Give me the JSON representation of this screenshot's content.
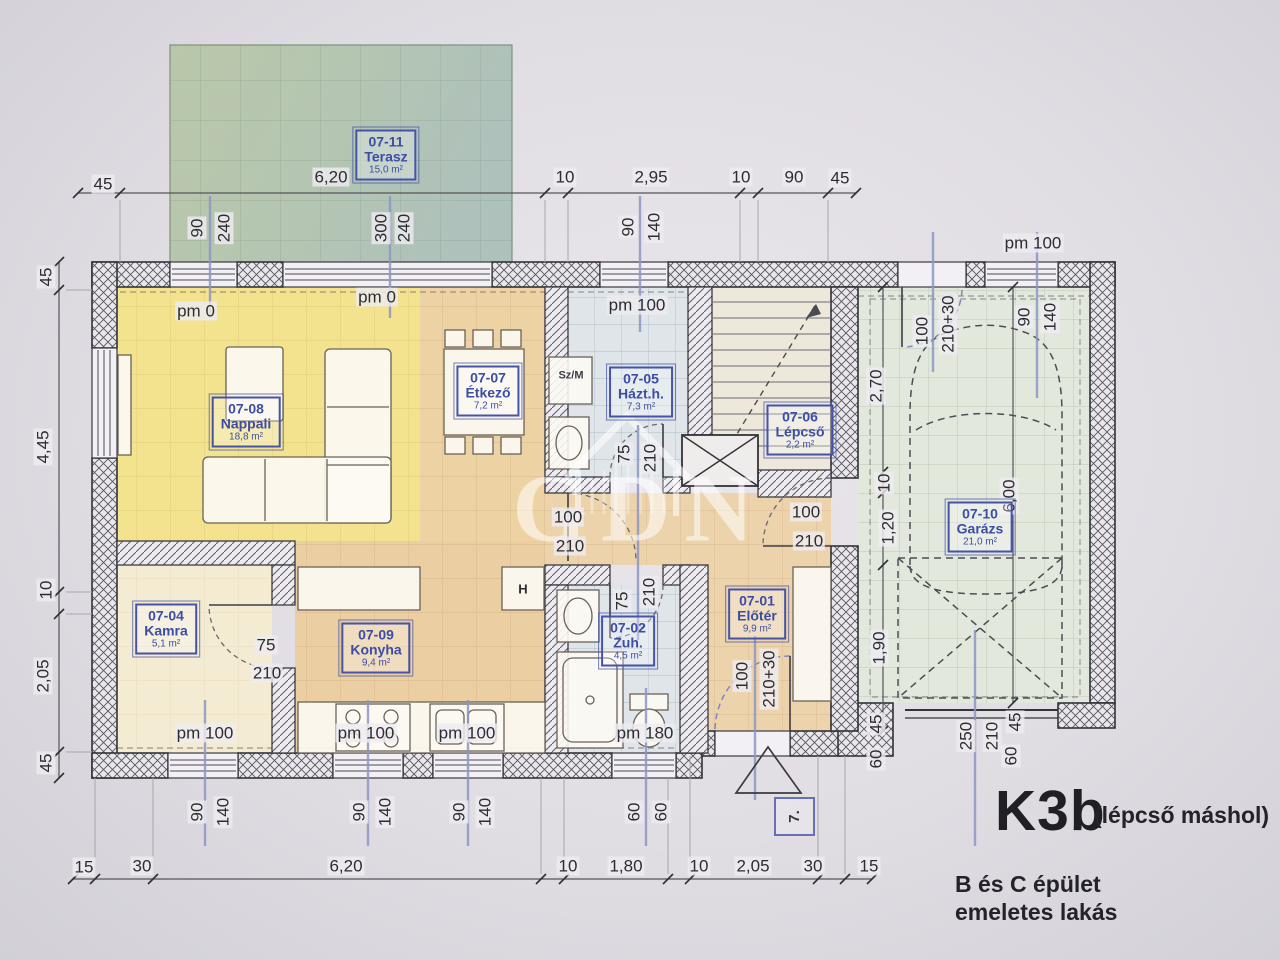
{
  "title": {
    "code": "K3b",
    "note": "(lépcső máshol)",
    "building_line1": "B és C épület",
    "building_line2": "emeletes lakás",
    "stamp": "7."
  },
  "watermark": {
    "text": "GDN"
  },
  "rooms": [
    {
      "code": "07-11",
      "name": "Terasz",
      "area": "15,0 m²",
      "x": 386,
      "y": 155
    },
    {
      "code": "07-08",
      "name": "Nappali",
      "area": "18,8 m²",
      "x": 246,
      "y": 422
    },
    {
      "code": "07-07",
      "name": "Étkező",
      "area": "7,2 m²",
      "x": 488,
      "y": 391
    },
    {
      "code": "07-05",
      "name": "Házt.h.",
      "area": "7,3 m²",
      "x": 641,
      "y": 392
    },
    {
      "code": "07-06",
      "name": "Lépcső",
      "area": "2,2 m²",
      "x": 800,
      "y": 430
    },
    {
      "code": "07-10",
      "name": "Garázs",
      "area": "21,0 m²",
      "x": 980,
      "y": 527
    },
    {
      "code": "07-04",
      "name": "Kamra",
      "area": "5,1 m²",
      "x": 166,
      "y": 629
    },
    {
      "code": "07-09",
      "name": "Konyha",
      "area": "9,4 m²",
      "x": 376,
      "y": 648
    },
    {
      "code": "07-02",
      "name": "Zuh.",
      "area": "4,5 m²",
      "x": 628,
      "y": 641
    },
    {
      "code": "07-01",
      "name": "Előtér",
      "area": "9,9 m²",
      "x": 757,
      "y": 614
    }
  ],
  "dims": [
    {
      "t": "45",
      "x": 103,
      "y": 184
    },
    {
      "t": "6,20",
      "x": 331,
      "y": 177
    },
    {
      "t": "10",
      "x": 565,
      "y": 177
    },
    {
      "t": "2,95",
      "x": 651,
      "y": 177
    },
    {
      "t": "10",
      "x": 741,
      "y": 177
    },
    {
      "t": "90",
      "x": 794,
      "y": 177
    },
    {
      "t": "45",
      "x": 840,
      "y": 178
    },
    {
      "t": "pm 100",
      "x": 1033,
      "y": 243
    },
    {
      "t": "pm 0",
      "x": 196,
      "y": 311
    },
    {
      "t": "pm 0",
      "x": 377,
      "y": 297
    },
    {
      "t": "pm 100",
      "x": 637,
      "y": 305
    },
    {
      "t": "15",
      "x": 84,
      "y": 867
    },
    {
      "t": "30",
      "x": 142,
      "y": 866
    },
    {
      "t": "6,20",
      "x": 346,
      "y": 866
    },
    {
      "t": "10",
      "x": 568,
      "y": 866
    },
    {
      "t": "1,80",
      "x": 626,
      "y": 866
    },
    {
      "t": "10",
      "x": 699,
      "y": 866
    },
    {
      "t": "2,05",
      "x": 753,
      "y": 866
    },
    {
      "t": "30",
      "x": 813,
      "y": 866
    },
    {
      "t": "15",
      "x": 869,
      "y": 866
    },
    {
      "t": "pm 100",
      "x": 205,
      "y": 733
    },
    {
      "t": "pm 100",
      "x": 366,
      "y": 733
    },
    {
      "t": "pm 100",
      "x": 467,
      "y": 733
    },
    {
      "t": "pm 180",
      "x": 645,
      "y": 733
    },
    {
      "t": "100",
      "x": 568,
      "y": 517
    },
    {
      "t": "210",
      "x": 570,
      "y": 546
    },
    {
      "t": "100",
      "x": 806,
      "y": 512
    },
    {
      "t": "210",
      "x": 809,
      "y": 541
    },
    {
      "t": "75",
      "x": 266,
      "y": 645
    },
    {
      "t": "210",
      "x": 267,
      "y": 673
    },
    {
      "t": "90",
      "x": 197,
      "y": 228,
      "r": 1
    },
    {
      "t": "240",
      "x": 224,
      "y": 228,
      "r": 1
    },
    {
      "t": "300",
      "x": 381,
      "y": 228,
      "r": 1
    },
    {
      "t": "240",
      "x": 404,
      "y": 228,
      "r": 1
    },
    {
      "t": "90",
      "x": 628,
      "y": 227,
      "r": 1
    },
    {
      "t": "140",
      "x": 654,
      "y": 227,
      "r": 1
    },
    {
      "t": "45",
      "x": 46,
      "y": 277,
      "r": 1
    },
    {
      "t": "4,45",
      "x": 43,
      "y": 447,
      "r": 1
    },
    {
      "t": "10",
      "x": 46,
      "y": 590,
      "r": 1
    },
    {
      "t": "2,05",
      "x": 43,
      "y": 676,
      "r": 1
    },
    {
      "t": "45",
      "x": 46,
      "y": 763,
      "r": 1
    },
    {
      "t": "2,70",
      "x": 876,
      "y": 386,
      "r": 1
    },
    {
      "t": "100",
      "x": 922,
      "y": 331,
      "r": 1
    },
    {
      "t": "210+30",
      "x": 948,
      "y": 324,
      "r": 1
    },
    {
      "t": "90",
      "x": 1024,
      "y": 317,
      "r": 1
    },
    {
      "t": "140",
      "x": 1050,
      "y": 317,
      "r": 1
    },
    {
      "t": "6,00",
      "x": 1009,
      "y": 496,
      "r": 1
    },
    {
      "t": "10",
      "x": 884,
      "y": 483,
      "r": 1
    },
    {
      "t": "1,20",
      "x": 888,
      "y": 528,
      "r": 1
    },
    {
      "t": "1,90",
      "x": 879,
      "y": 648,
      "r": 1
    },
    {
      "t": "45",
      "x": 876,
      "y": 724,
      "r": 1
    },
    {
      "t": "60",
      "x": 876,
      "y": 759,
      "r": 1
    },
    {
      "t": "250",
      "x": 966,
      "y": 736,
      "r": 1
    },
    {
      "t": "210",
      "x": 992,
      "y": 736,
      "r": 1
    },
    {
      "t": "45",
      "x": 1015,
      "y": 722,
      "r": 1
    },
    {
      "t": "60",
      "x": 1011,
      "y": 756,
      "r": 1
    },
    {
      "t": "75",
      "x": 624,
      "y": 454,
      "r": 1
    },
    {
      "t": "210",
      "x": 650,
      "y": 458,
      "r": 1
    },
    {
      "t": "75",
      "x": 622,
      "y": 601,
      "r": 1
    },
    {
      "t": "210",
      "x": 649,
      "y": 592,
      "r": 1
    },
    {
      "t": "100",
      "x": 742,
      "y": 676,
      "r": 1
    },
    {
      "t": "210+30",
      "x": 769,
      "y": 679,
      "r": 1
    },
    {
      "t": "90",
      "x": 197,
      "y": 812,
      "r": 1
    },
    {
      "t": "140",
      "x": 223,
      "y": 812,
      "r": 1
    },
    {
      "t": "90",
      "x": 359,
      "y": 812,
      "r": 1
    },
    {
      "t": "140",
      "x": 385,
      "y": 812,
      "r": 1
    },
    {
      "t": "90",
      "x": 459,
      "y": 812,
      "r": 1
    },
    {
      "t": "140",
      "x": 485,
      "y": 812,
      "r": 1
    },
    {
      "t": "60",
      "x": 634,
      "y": 812,
      "r": 1
    },
    {
      "t": "60",
      "x": 661,
      "y": 812,
      "r": 1
    },
    {
      "t": "Sz/M",
      "x": 571,
      "y": 376,
      "s": "xs"
    },
    {
      "t": "H",
      "x": 523,
      "y": 589,
      "s": "sm"
    }
  ]
}
